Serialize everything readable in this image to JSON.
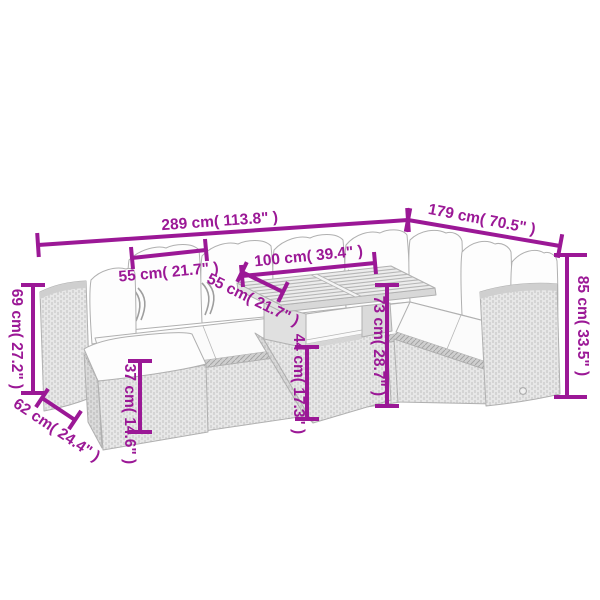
{
  "diagram": {
    "type": "product-dimension-diagram",
    "subject": "rattan-garden-lounge-set-with-table-and-ottoman",
    "units": [
      "cm",
      "inch"
    ],
    "dims": {
      "total_width": "289 cm( 113.8\" )",
      "total_depth": "179 cm( 70.5\" )",
      "seat_width": "55 cm( 21.7\" )",
      "table_length": "100 cm( 39.4\" )",
      "table_depth": "55 cm( 21.7\" )",
      "left_back_height": "69 cm( 27.2\" )",
      "seat_depth": "62 cm( 24.4\" )",
      "ottoman_height": "37 cm( 14.6\" )",
      "table_base_height": "44 cm( 17.3\" )",
      "table_height": "73 cm( 28.7\" )",
      "total_height": "85 cm( 33.5\" )"
    },
    "colors": {
      "dimension_accent": "#9B1896",
      "sketch_line": "#b0b0b0",
      "background": "#ffffff"
    }
  }
}
